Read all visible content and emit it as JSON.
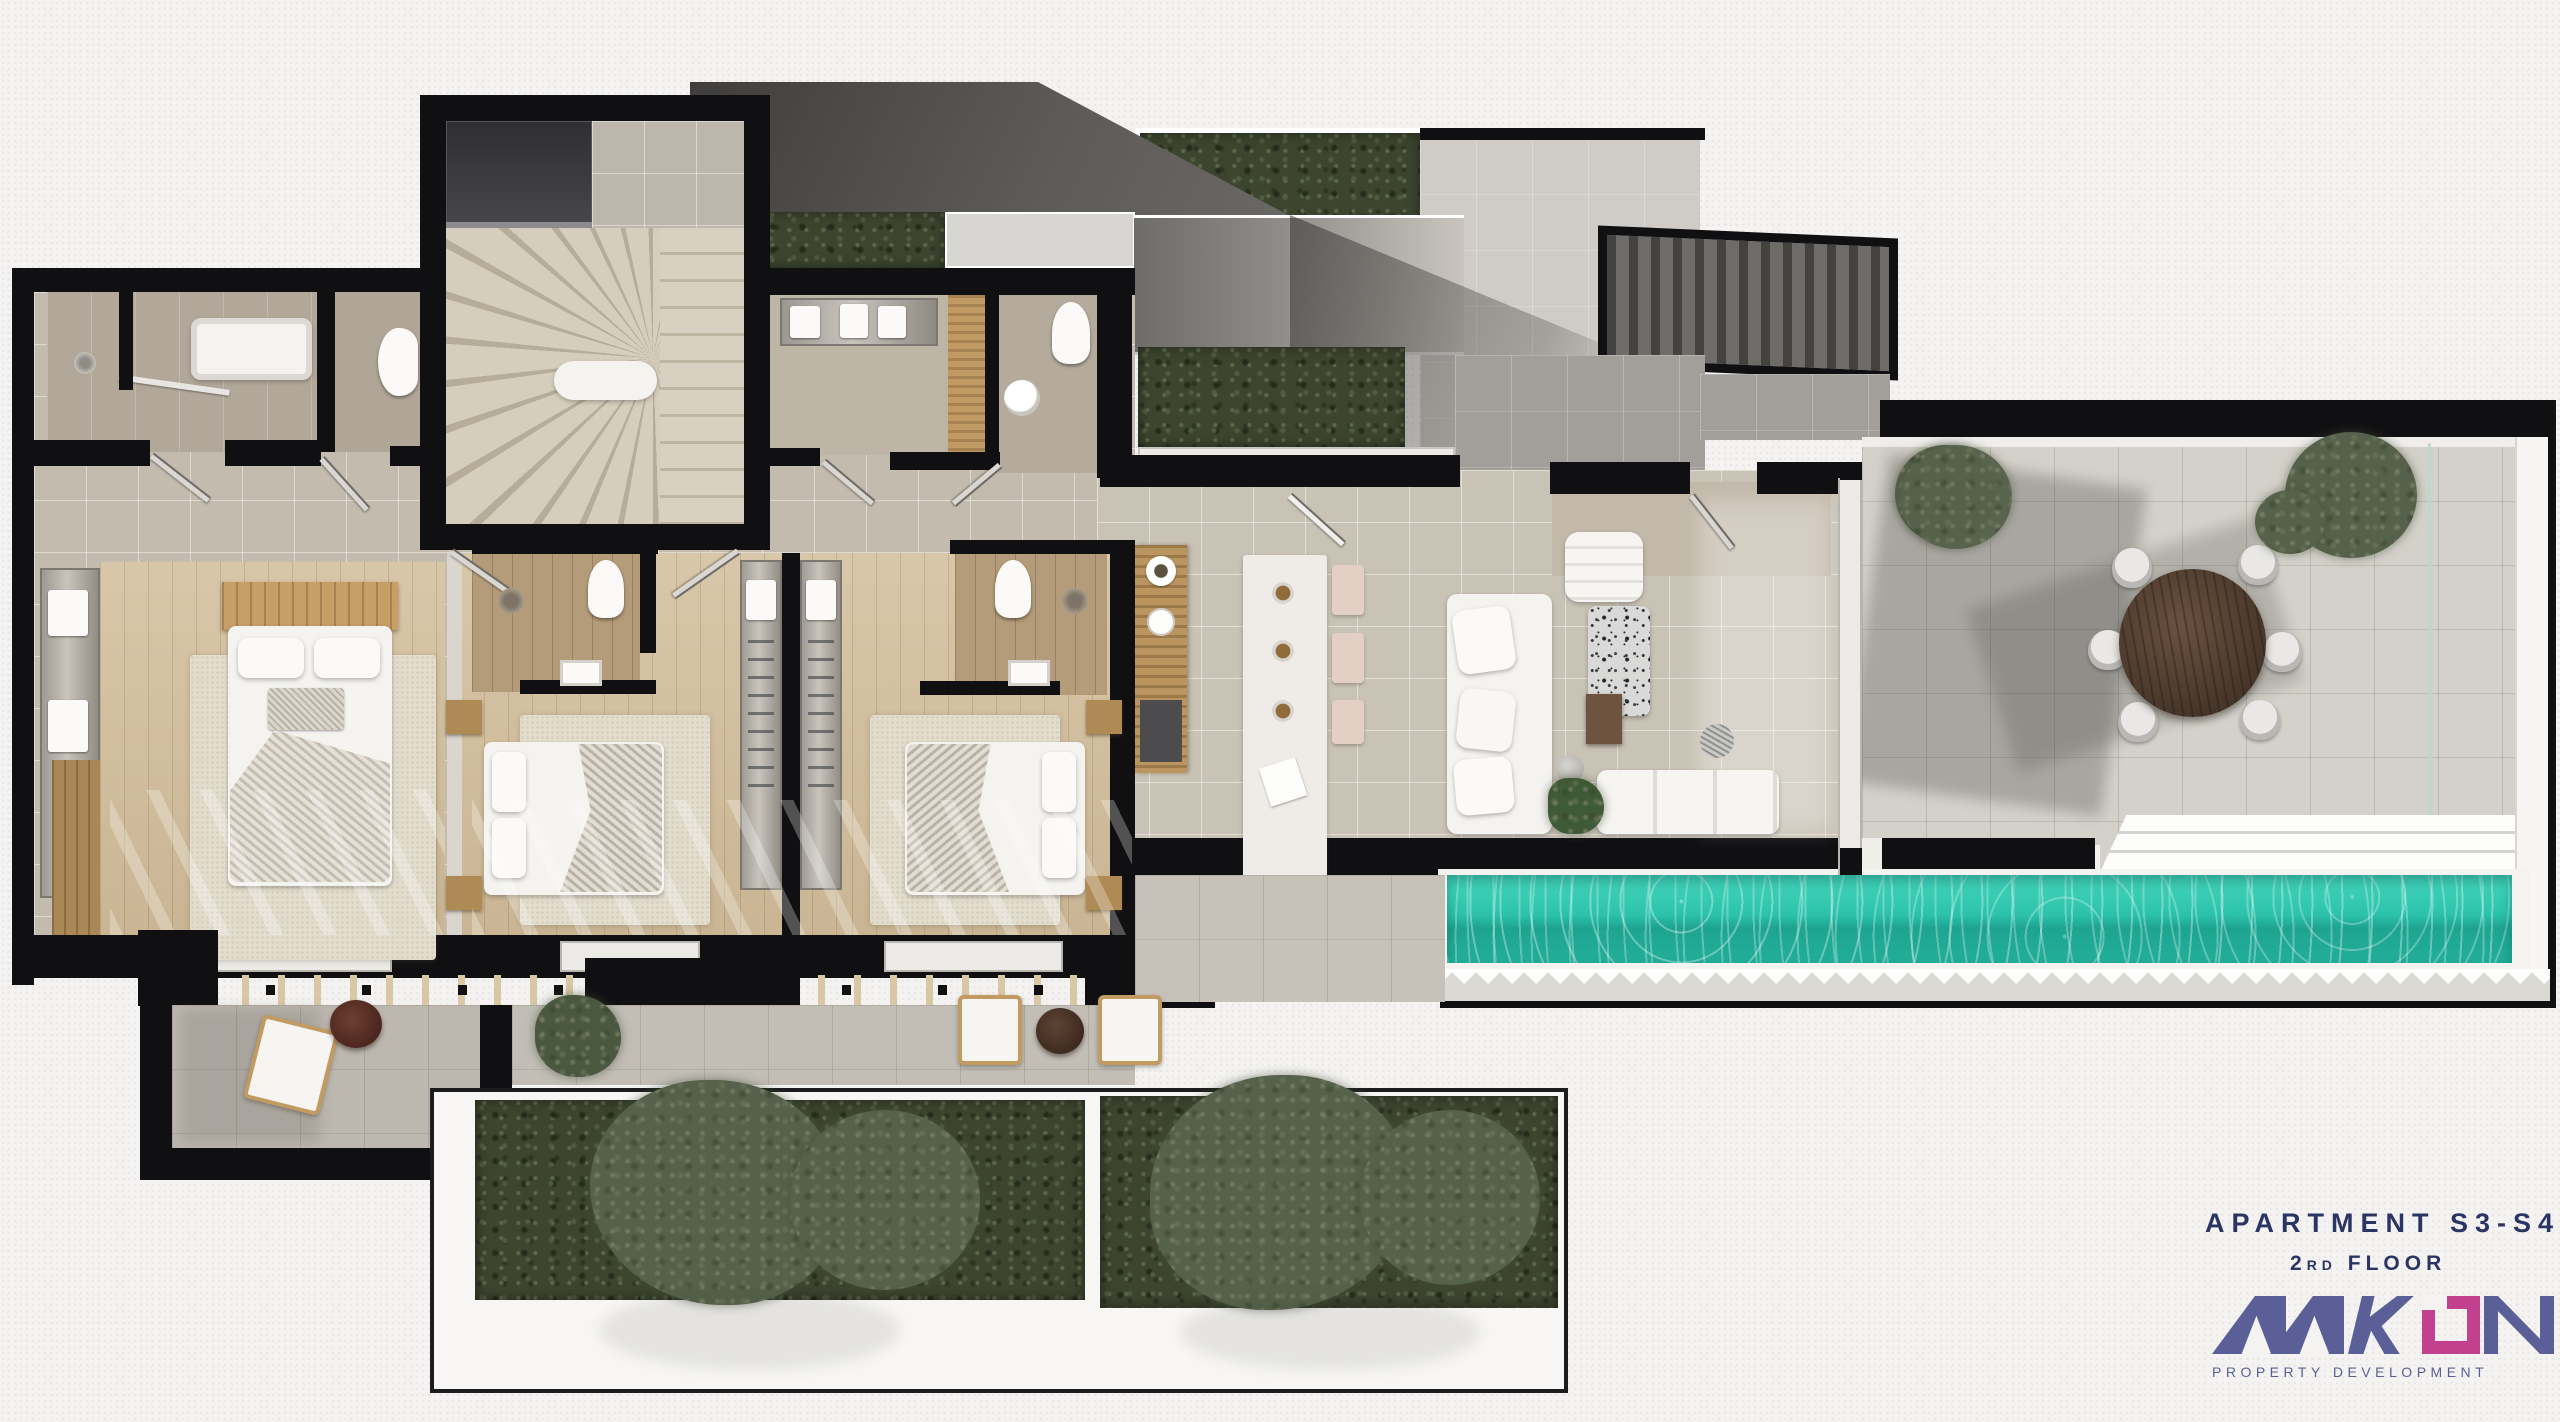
{
  "title_block": {
    "title": "APARTMENT S3-S4",
    "floor_number": "2",
    "floor_suffix": "RD",
    "floor_word": "FLOOR"
  },
  "logo": {
    "name": "AAKON",
    "letters": [
      "A",
      "A",
      "K",
      "O",
      "N"
    ],
    "tagline": "PROPERTY DEVELOPMENT"
  },
  "colors": {
    "wall_black": "#101012",
    "interior_tile": "#c3bcae",
    "terrace_tile": "#d4d1ca",
    "courtyard_gray": "#a29f9a",
    "wood_floor": "#d3bf9d",
    "ensuite_wood": "#b49b79",
    "hedge_green": "#3d452f",
    "pool_teal": "#2cc4ad",
    "roof_slab": "#5a5855",
    "accent_navy": "#2b3563",
    "accent_slate": "#5a6097",
    "accent_magenta": "#c2418f"
  }
}
